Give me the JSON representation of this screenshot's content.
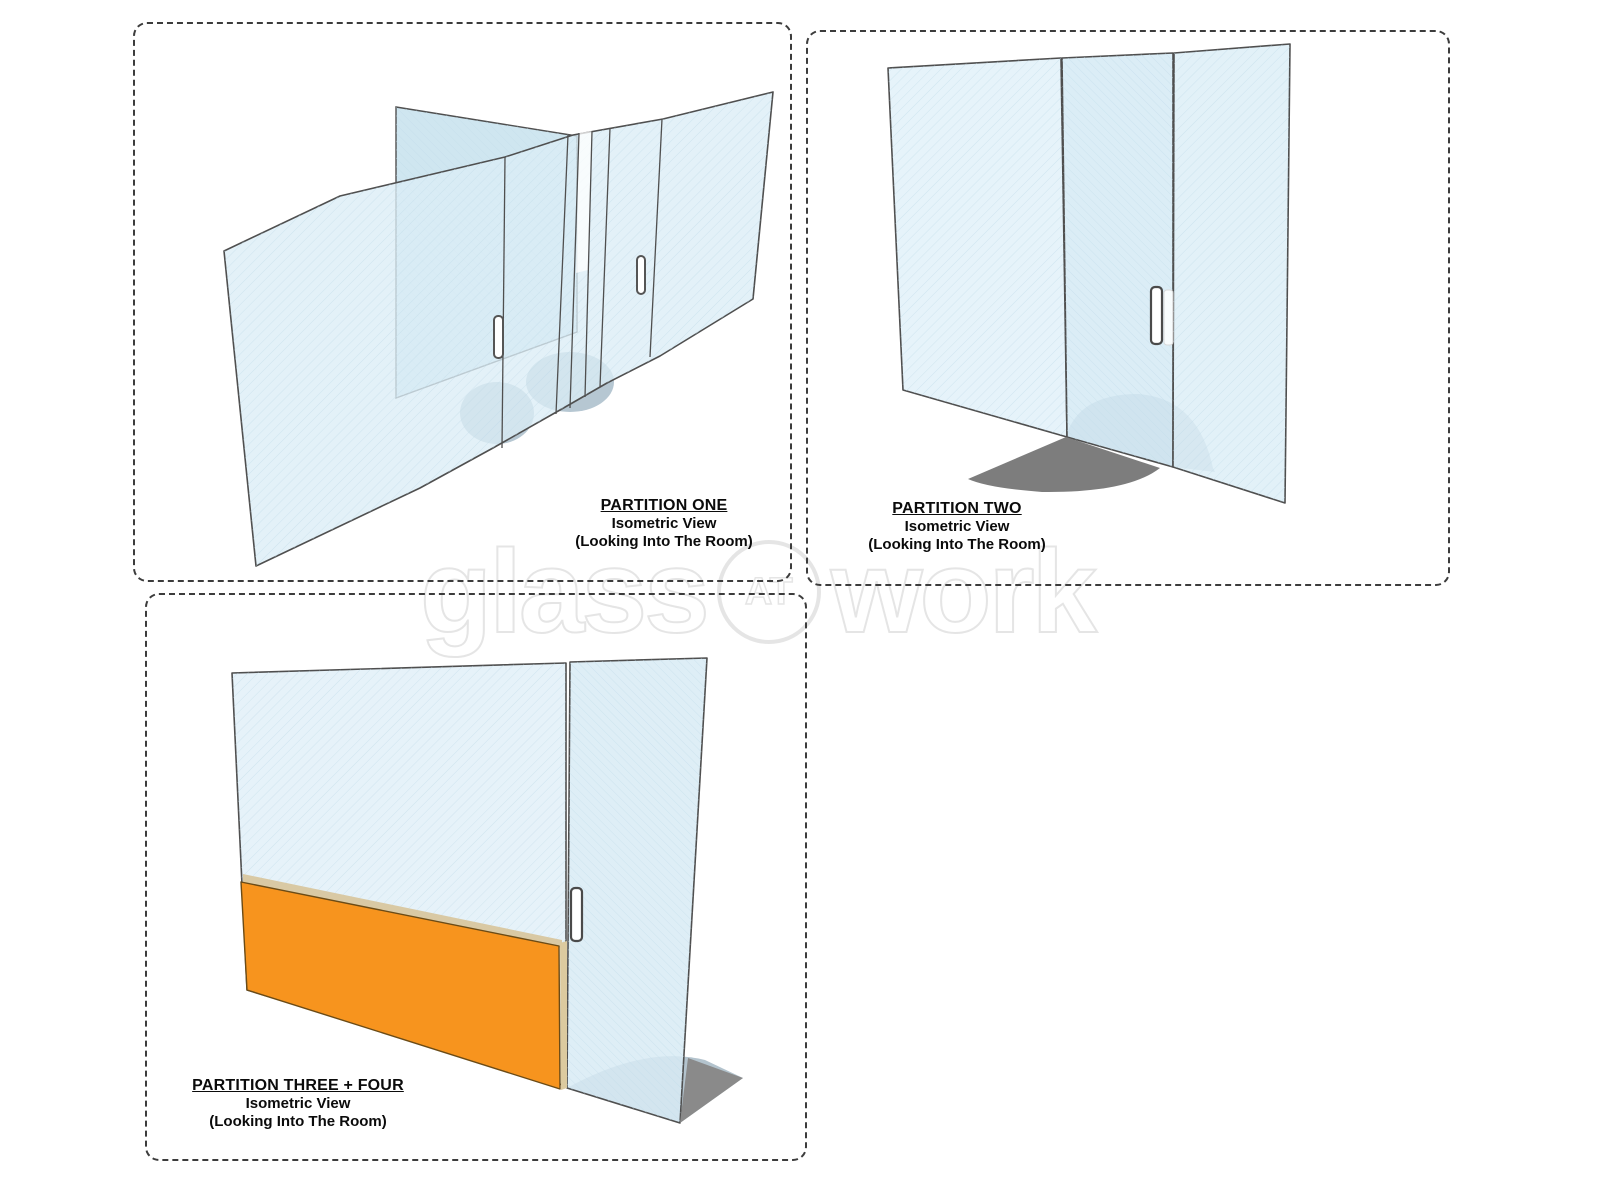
{
  "sheet": {
    "type": "glass partition isometric drawing sheet",
    "background": "#FFFFFF"
  },
  "watermark": {
    "part1": "glass",
    "part2": "AT",
    "part3": "work"
  },
  "partitions": [
    {
      "title": "PARTITION ONE",
      "view": "Isometric View",
      "note": "(Looking Into The Room)"
    },
    {
      "title": "PARTITION TWO",
      "view": "Isometric View",
      "note": "(Looking Into The Room)"
    },
    {
      "title": "PARTITION THREE + FOUR",
      "view": "Isometric View",
      "note": "(Looking Into The Room)"
    }
  ],
  "colors": {
    "accent_orange": "#F7941E",
    "glass_tint": "#DCEDF5",
    "glass_tint_dark": "#CFE6F0",
    "glass_edge": "#4F4F4F",
    "shadow_dark": "#7D7D7D",
    "shadow_behind_glass": "#B3C3CD",
    "frame_tan": "#D9C9A4",
    "dashed_border": "#3C3C3C"
  }
}
